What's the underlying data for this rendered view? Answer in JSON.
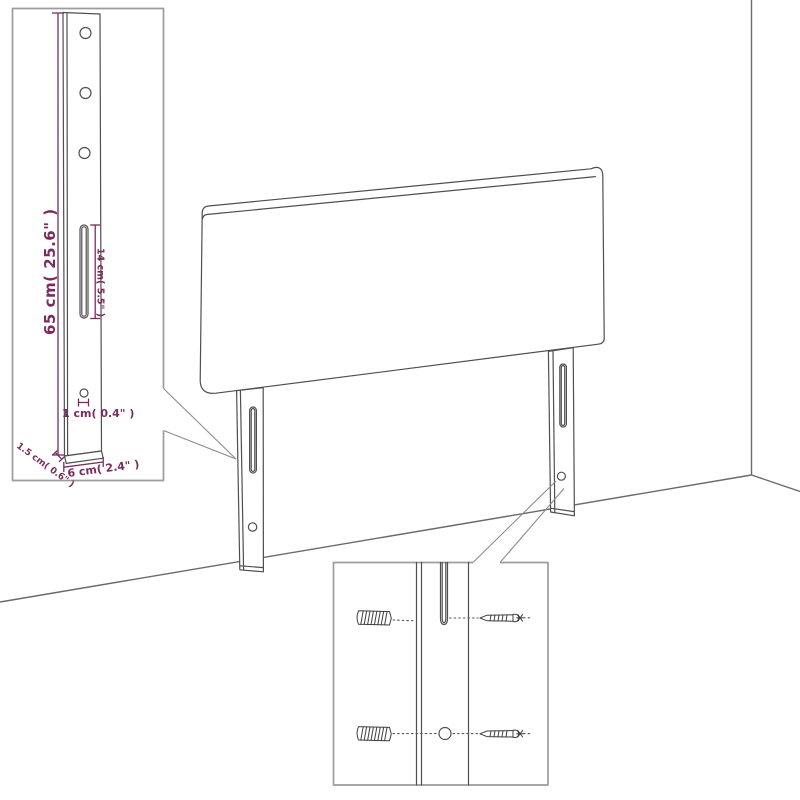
{
  "diagram": {
    "subject": "headboard-dimension-diagram",
    "background": "#ffffff",
    "line_color": "#4f4f4f",
    "box_border_color": "#9c9c9c",
    "dimension_color": "#7b2c5e",
    "left_callout": {
      "height_label": "65 cm( 25.6\" )",
      "slot_height_label": "14 cm( 5.5\" )",
      "bottom_hole_label": "1 cm( 0.4\" )",
      "thickness_label": "1.5 cm( 0.6\" )",
      "width_label": "6 cm( 2.4\" )"
    }
  }
}
